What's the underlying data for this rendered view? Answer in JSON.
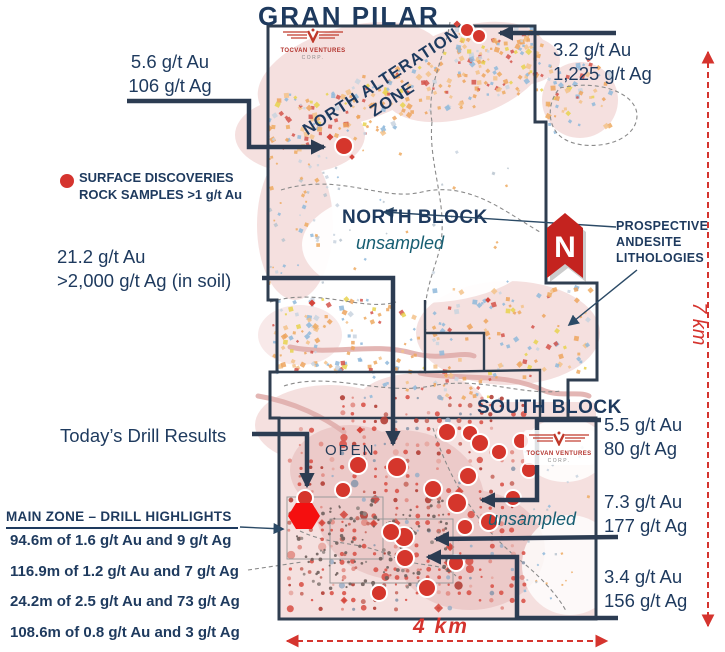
{
  "title": "GRAN PILAR",
  "logo": {
    "name": "TOCVAN VENTURES",
    "sub": "CORP."
  },
  "map_labels": {
    "north_alteration_line1": "NORTH ALTERATION",
    "north_alteration_line2": "ZONE",
    "north_block": "NORTH BLOCK",
    "north_block_note": "unsampled",
    "south_block": "SOUTH BLOCK",
    "south_block_note": "unsampled",
    "open": "OPEN",
    "north_indicator": "N"
  },
  "legend": {
    "surface_line1": "SURFACE DISCOVERIES",
    "surface_line2": "ROCK SAMPLES >1 g/t Au"
  },
  "annotations": {
    "northwest_sample": {
      "l1": "5.6 g/t Au",
      "l2": "106 g/t Ag"
    },
    "northeast_sample": {
      "l1": "3.2 g/t Au",
      "l2": "1,225 g/t Ag"
    },
    "soil_sample": {
      "l1": "21.2 g/t Au",
      "l2": ">2,000 g/t Ag (in soil)"
    },
    "prospective": {
      "l1": "PROSPECTIVE",
      "l2": "ANDESITE",
      "l3": "LITHOLOGIES"
    },
    "southeast_sample_1": {
      "l1": "5.5 g/t Au",
      "l2": "80 g/t Ag"
    },
    "southeast_sample_2": {
      "l1": "7.3 g/t Au",
      "l2": "177 g/t Ag"
    },
    "southeast_sample_3": {
      "l1": "3.4 g/t Au",
      "l2": "156 g/t Ag"
    },
    "todays_drill": "Today’s Drill Results"
  },
  "drill_highlights": {
    "heading": "MAIN ZONE – DRILL HIGHLIGHTS",
    "rows": [
      "94.6m of 1.6 g/t Au and 9 g/t Ag",
      "116.9m of 1.2 g/t Au and 7 g/t Ag",
      "24.2m of 2.5 g/t Au and 73 g/t Ag",
      "108.6m of 0.8 g/t Au and 3 g/t Ag"
    ]
  },
  "scale": {
    "vertical_label": "7 km",
    "horizontal_label": "4 km"
  },
  "colors": {
    "navy_text": "#1e3a5e",
    "teal_italic": "#175e72",
    "red": "#d5342e",
    "bright_red_hexagon": "#f50f0f",
    "pink_alteration": "#f5e0df",
    "rose_deep": "#eccac9",
    "orange_speck": "#eda55e",
    "blue_speck": "#8fb8da",
    "connector_navy": "#2c3c52"
  }
}
